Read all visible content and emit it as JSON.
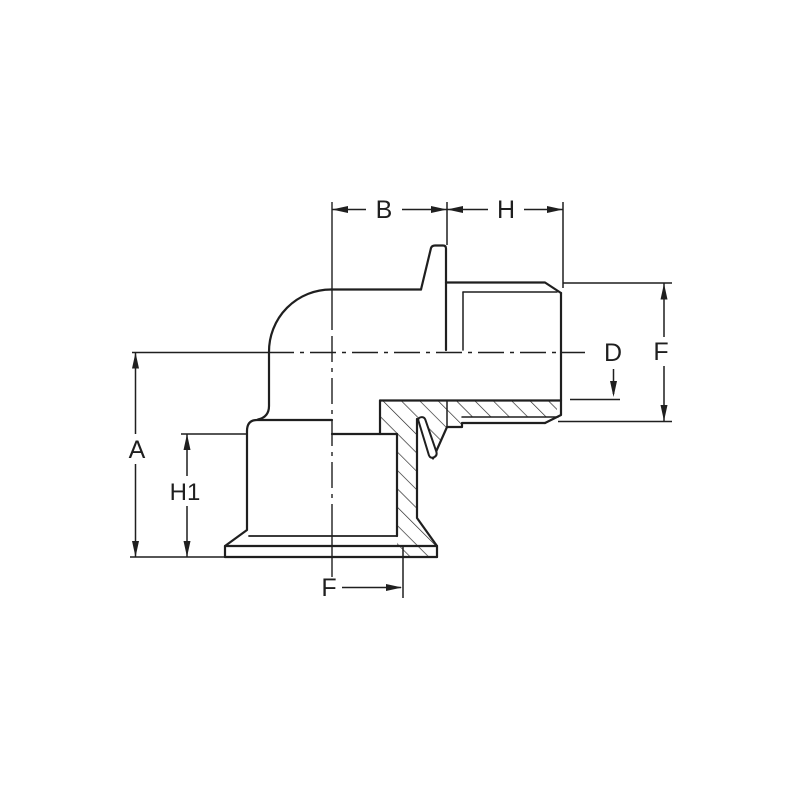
{
  "canvas": {
    "background_color": "#ffffff",
    "line_color": "#1f1f1f"
  },
  "drawing": {
    "description": "Dimensioned cross-section technical drawing of a 90-degree elbow fitting with a male threaded horizontal outlet (right) and a flanged female socket outlet (bottom)",
    "dimensions": [
      {
        "id": "A",
        "label": "A"
      },
      {
        "id": "B",
        "label": "B"
      },
      {
        "id": "H",
        "label": "H"
      },
      {
        "id": "H1",
        "label": "H1"
      },
      {
        "id": "D",
        "label": "D"
      },
      {
        "id": "F_right",
        "label": "F"
      },
      {
        "id": "F_bottom",
        "label": "F"
      }
    ]
  }
}
